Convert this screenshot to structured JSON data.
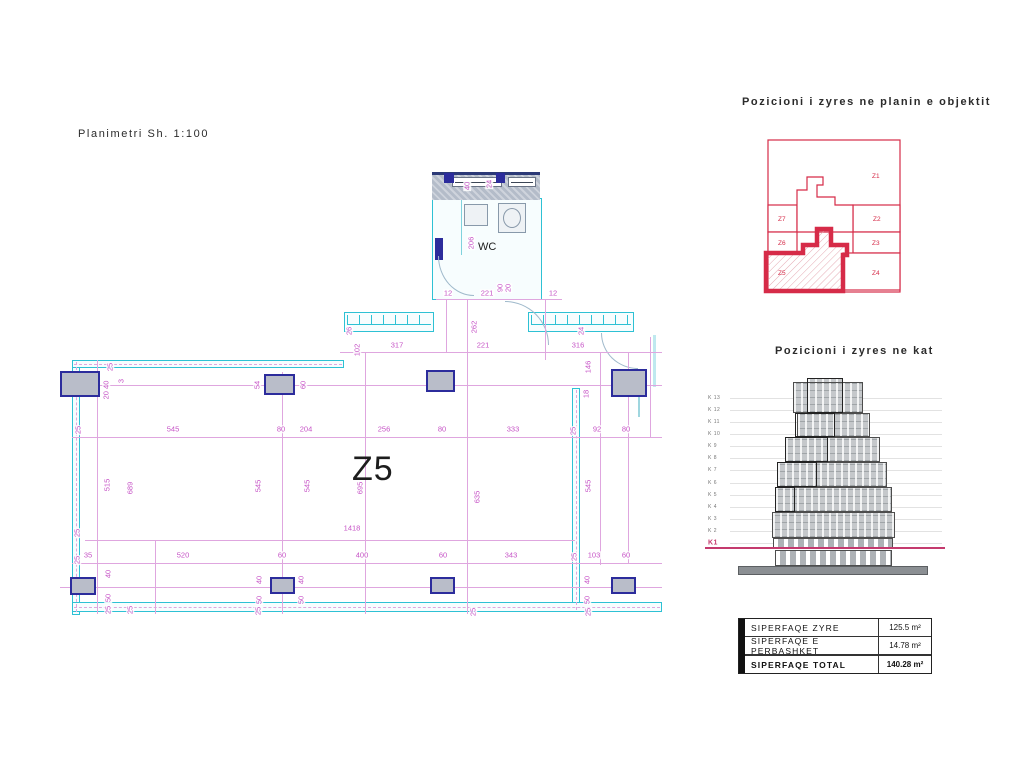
{
  "plan": {
    "title": "Planimetri Sh. 1:100",
    "room_label": "Z5",
    "wc_label": "WC",
    "colors": {
      "wall": "#2ec1d4",
      "dim": "#c653c6",
      "dim_line": "#dfa6df",
      "column_fill": "#b9bdc9",
      "column_border": "#2c2c9c"
    },
    "h_dims": [
      {
        "t": "317",
        "x": 397,
        "y": 345
      },
      {
        "t": "221",
        "x": 483,
        "y": 345
      },
      {
        "t": "316",
        "x": 578,
        "y": 345
      },
      {
        "t": "12",
        "x": 448,
        "y": 293
      },
      {
        "t": "221",
        "x": 487,
        "y": 293
      },
      {
        "t": "12",
        "x": 553,
        "y": 293
      },
      {
        "t": "545",
        "x": 173,
        "y": 429
      },
      {
        "t": "80",
        "x": 281,
        "y": 429
      },
      {
        "t": "204",
        "x": 306,
        "y": 429
      },
      {
        "t": "256",
        "x": 384,
        "y": 429
      },
      {
        "t": "80",
        "x": 442,
        "y": 429
      },
      {
        "t": "333",
        "x": 513,
        "y": 429
      },
      {
        "t": "92",
        "x": 597,
        "y": 429
      },
      {
        "t": "80",
        "x": 626,
        "y": 429
      },
      {
        "t": "1418",
        "x": 352,
        "y": 528
      },
      {
        "t": "35",
        "x": 88,
        "y": 555
      },
      {
        "t": "520",
        "x": 183,
        "y": 555
      },
      {
        "t": "60",
        "x": 282,
        "y": 555
      },
      {
        "t": "400",
        "x": 362,
        "y": 555
      },
      {
        "t": "60",
        "x": 443,
        "y": 555
      },
      {
        "t": "343",
        "x": 511,
        "y": 555
      },
      {
        "t": "103",
        "x": 594,
        "y": 555
      },
      {
        "t": "60",
        "x": 626,
        "y": 555
      }
    ],
    "v_dims": [
      {
        "t": "102",
        "x": 357,
        "y": 350
      },
      {
        "t": "262",
        "x": 474,
        "y": 327
      },
      {
        "t": "146",
        "x": 588,
        "y": 367
      },
      {
        "t": "206",
        "x": 471,
        "y": 243
      },
      {
        "t": "40",
        "x": 467,
        "y": 186
      },
      {
        "t": "24",
        "x": 489,
        "y": 184
      },
      {
        "t": "90",
        "x": 500,
        "y": 288
      },
      {
        "t": "20",
        "x": 508,
        "y": 288
      },
      {
        "t": "26",
        "x": 349,
        "y": 331
      },
      {
        "t": "24",
        "x": 581,
        "y": 331
      },
      {
        "t": "20 40",
        "x": 106,
        "y": 390
      },
      {
        "t": "3",
        "x": 121,
        "y": 381
      },
      {
        "t": "54",
        "x": 257,
        "y": 385
      },
      {
        "t": "60",
        "x": 303,
        "y": 385
      },
      {
        "t": "25",
        "x": 110,
        "y": 367
      },
      {
        "t": "515",
        "x": 107,
        "y": 485
      },
      {
        "t": "689",
        "x": 130,
        "y": 488
      },
      {
        "t": "545",
        "x": 258,
        "y": 486
      },
      {
        "t": "545",
        "x": 307,
        "y": 486
      },
      {
        "t": "695",
        "x": 360,
        "y": 488
      },
      {
        "t": "635",
        "x": 477,
        "y": 497
      },
      {
        "t": "545",
        "x": 588,
        "y": 486
      },
      {
        "t": "18",
        "x": 586,
        "y": 394
      },
      {
        "t": "25",
        "x": 573,
        "y": 431
      },
      {
        "t": "25",
        "x": 78,
        "y": 430
      },
      {
        "t": "25",
        "x": 77,
        "y": 533
      },
      {
        "t": "25",
        "x": 77,
        "y": 560
      },
      {
        "t": "25",
        "x": 574,
        "y": 557
      },
      {
        "t": "40",
        "x": 108,
        "y": 574
      },
      {
        "t": "50",
        "x": 108,
        "y": 598
      },
      {
        "t": "40",
        "x": 259,
        "y": 580
      },
      {
        "t": "50",
        "x": 259,
        "y": 600
      },
      {
        "t": "40",
        "x": 301,
        "y": 580
      },
      {
        "t": "50",
        "x": 301,
        "y": 600
      },
      {
        "t": "40",
        "x": 587,
        "y": 580
      },
      {
        "t": "50",
        "x": 587,
        "y": 600
      },
      {
        "t": "25",
        "x": 108,
        "y": 610
      },
      {
        "t": "25",
        "x": 130,
        "y": 610
      },
      {
        "t": "25",
        "x": 258,
        "y": 611
      },
      {
        "t": "25",
        "x": 473,
        "y": 612
      },
      {
        "t": "25",
        "x": 588,
        "y": 612
      }
    ],
    "h_lines": [
      [
        299,
        436,
        562
      ],
      [
        352,
        340,
        662
      ],
      [
        385,
        60,
        662
      ],
      [
        437,
        72,
        662
      ],
      [
        540,
        85,
        575
      ],
      [
        563,
        72,
        662
      ],
      [
        587,
        60,
        662
      ]
    ],
    "v_lines": [
      [
        97,
        360,
        614
      ],
      [
        155,
        540,
        614
      ],
      [
        282,
        372,
        614
      ],
      [
        365,
        352,
        614
      ],
      [
        467,
        299,
        614
      ],
      [
        545,
        299,
        360
      ],
      [
        600,
        352,
        565
      ],
      [
        628,
        352,
        563
      ],
      [
        650,
        337,
        437
      ],
      [
        446,
        299,
        352
      ]
    ],
    "columns": [
      [
        60,
        371,
        40,
        26
      ],
      [
        264,
        374,
        31,
        21
      ],
      [
        426,
        370,
        29,
        22
      ],
      [
        611,
        369,
        36,
        28
      ],
      [
        70,
        577,
        26,
        18
      ],
      [
        270,
        577,
        25,
        17
      ],
      [
        430,
        577,
        25,
        17
      ],
      [
        611,
        577,
        25,
        17
      ]
    ]
  },
  "zone_map": {
    "title": "Pozicioni i zyres ne planin e objektit",
    "accent": "#d62b48",
    "highlight": "Z5",
    "zones": [
      {
        "label": "Z1"
      },
      {
        "label": "Z7"
      },
      {
        "label": "Z6"
      },
      {
        "label": "Z2"
      },
      {
        "label": "Z3"
      },
      {
        "label": "Z5"
      },
      {
        "label": "Z4"
      }
    ]
  },
  "elevation": {
    "title": "Pozicioni i zyres ne kat",
    "floors": [
      "K 13",
      "K 12",
      "K 11",
      "K 10",
      "K 9",
      "K 8",
      "K 7",
      "K 6",
      "K 5",
      "K 4",
      "K 3",
      "K 2",
      "K1"
    ],
    "highlight_floor": "K1",
    "marker_color": "#c43a6e"
  },
  "summary_table": {
    "rows": [
      {
        "label": "SIPERFAQE ZYRE",
        "value": "125.5 m²",
        "bold": false
      },
      {
        "label": "SIPERFAQE E PERBASHKET",
        "value": "14.78 m²",
        "bold": false
      },
      {
        "label": "SIPERFAQE TOTAL",
        "value": "140.28 m²",
        "bold": true
      }
    ]
  }
}
